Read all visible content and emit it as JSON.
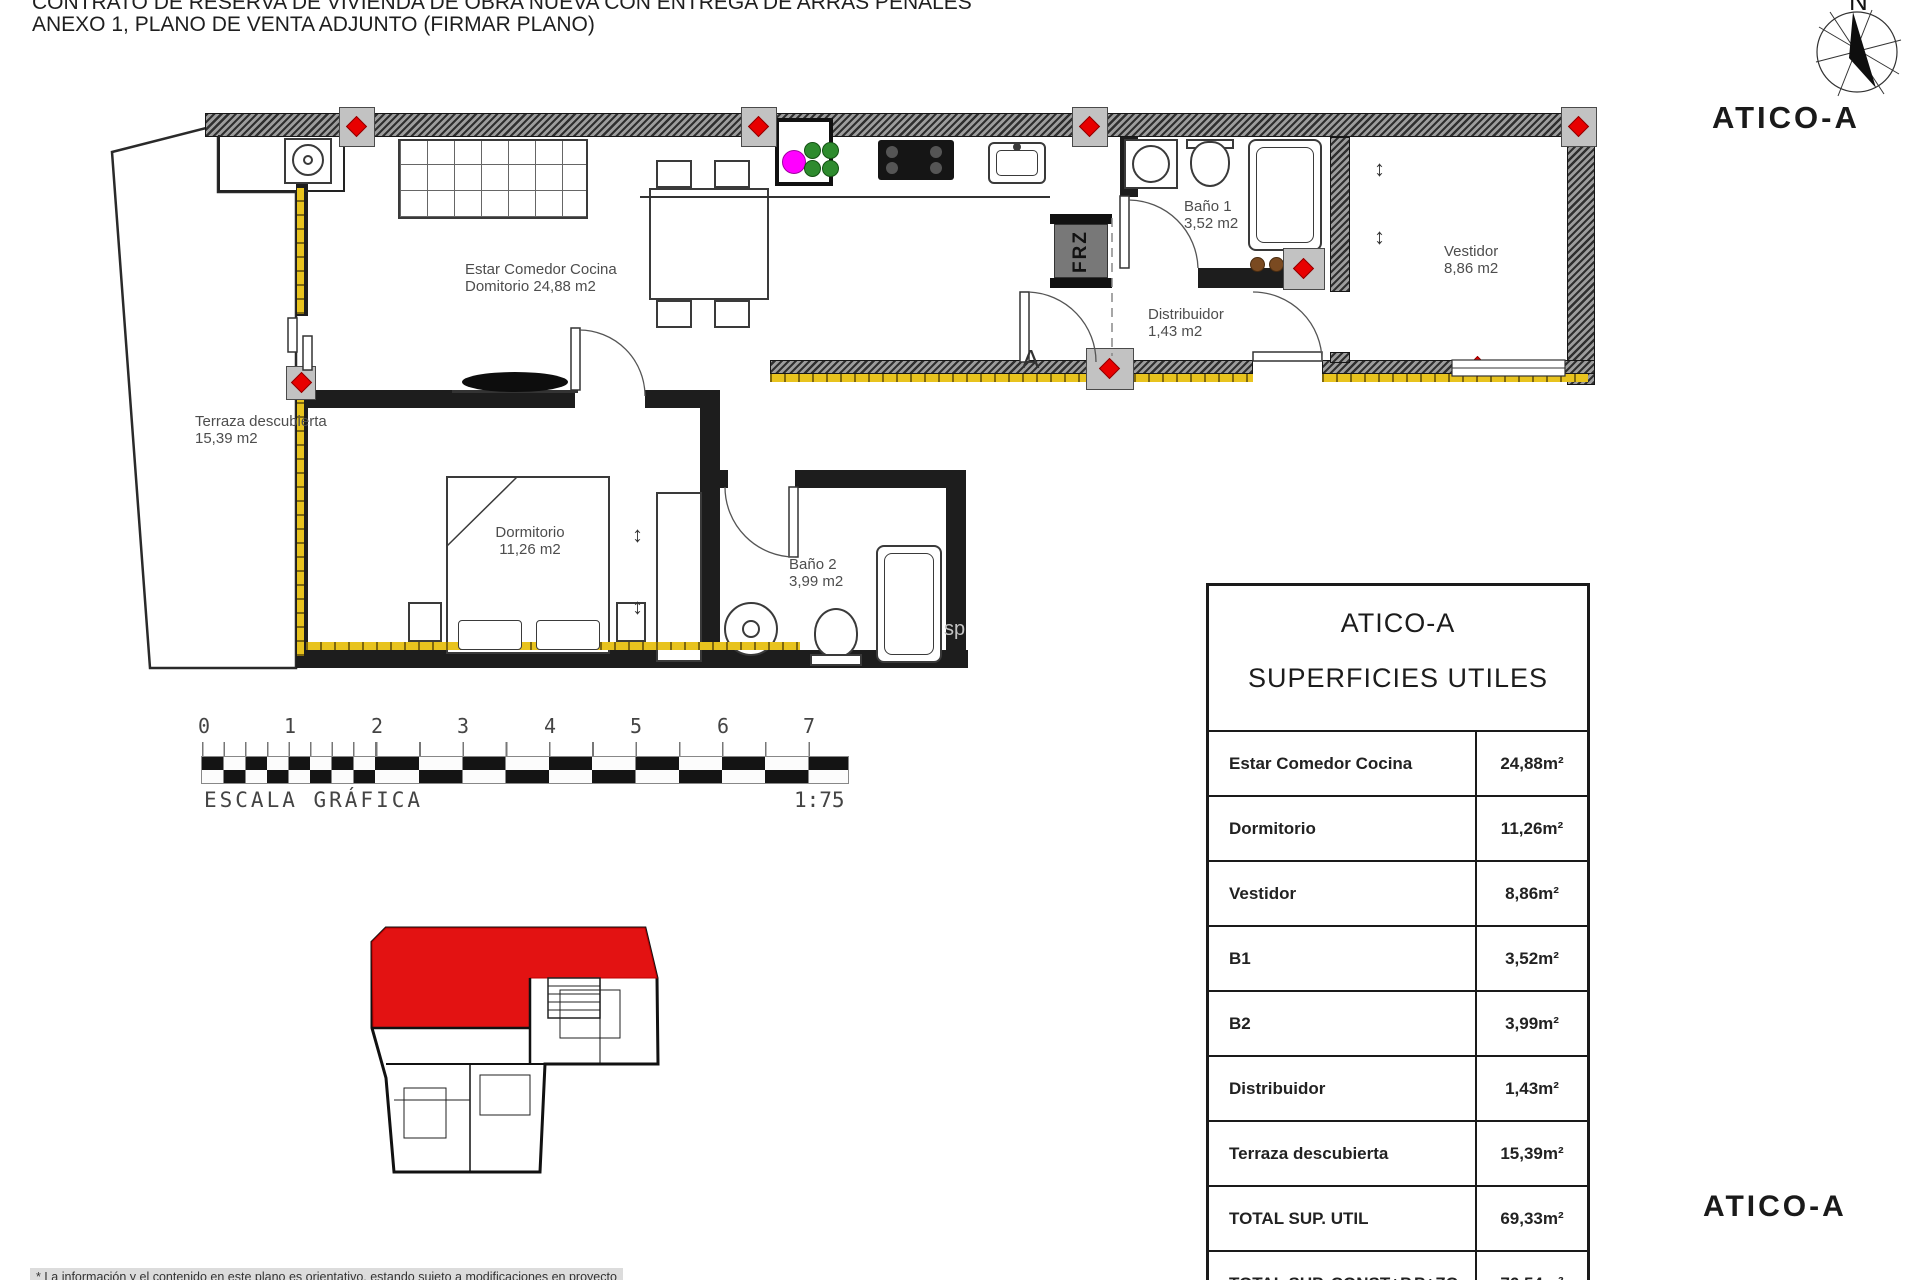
{
  "header": {
    "line1": "CONTRATO DE RESERVA DE VIVIENDA DE OBRA NUEVA CON ENTREGA DE ARRAS PENALES",
    "line2": "ANEXO 1, PLANO DE VENTA ADJUNTO (FIRMAR PLANO)"
  },
  "titles": {
    "top_right": "ATICO-A",
    "bottom_right": "ATICO-A"
  },
  "compass": {
    "north": "N"
  },
  "plan": {
    "estar": {
      "name": "Estar Comedor Cocina",
      "line2": "Domitorio 24,88 m2"
    },
    "terraza": {
      "name": "Terraza descubierta",
      "line2": "15,39 m2"
    },
    "dormitorio": {
      "name": "Dormitorio",
      "line2": "11,26 m2"
    },
    "bano2": {
      "name": "Baño 2",
      "line2": "3,99 m2"
    },
    "bano1": {
      "name": "Baño 1",
      "line2": "3,52 m2"
    },
    "distribuidor": {
      "name": "Distribuidor",
      "line2": "1,43 m2"
    },
    "vestidor": {
      "name": "Vestidor",
      "line2": "8,86 m2"
    },
    "frz": "FRZ",
    "section_mark": "A",
    "watermark": "sp"
  },
  "icons": {
    "updown": "↕"
  },
  "scale_bar": {
    "ticks": [
      "0",
      "1",
      "2",
      "3",
      "4",
      "5",
      "6",
      "7"
    ],
    "label": "ESCALA GRÁFICA",
    "ratio": "1:75"
  },
  "table": {
    "title1": "ATICO-A",
    "title2": "SUPERFICIES UTILES",
    "rows": [
      {
        "label": "Estar Comedor Cocina",
        "value": "24,88m²"
      },
      {
        "label": "Dormitorio",
        "value": "11,26m²"
      },
      {
        "label": "Vestidor",
        "value": "8,86m²"
      },
      {
        "label": "B1",
        "value": "3,52m²"
      },
      {
        "label": "B2",
        "value": "3,99m²"
      },
      {
        "label": "Distribuidor",
        "value": "1,43m²"
      },
      {
        "label": "Terraza descubierta",
        "value": "15,39m²"
      },
      {
        "label": "TOTAL SUP. UTIL",
        "value": "69,33m²"
      },
      {
        "label": "TOTAL SUP. CONST+P.P+ZC",
        "value": "76,54m²"
      }
    ]
  },
  "footnote": "* La información y el contenido en este plano es orientativo, estando sujeto a modificaciones en proyecto",
  "colors": {
    "wall": "#1d1d1d",
    "insulation_yellow": "#e8c31e",
    "marker_red": "#e80000",
    "unit_highlight_red": "#e31212",
    "riser_magenta": "#ff00ff",
    "riser_green": "#2e8b2e"
  }
}
